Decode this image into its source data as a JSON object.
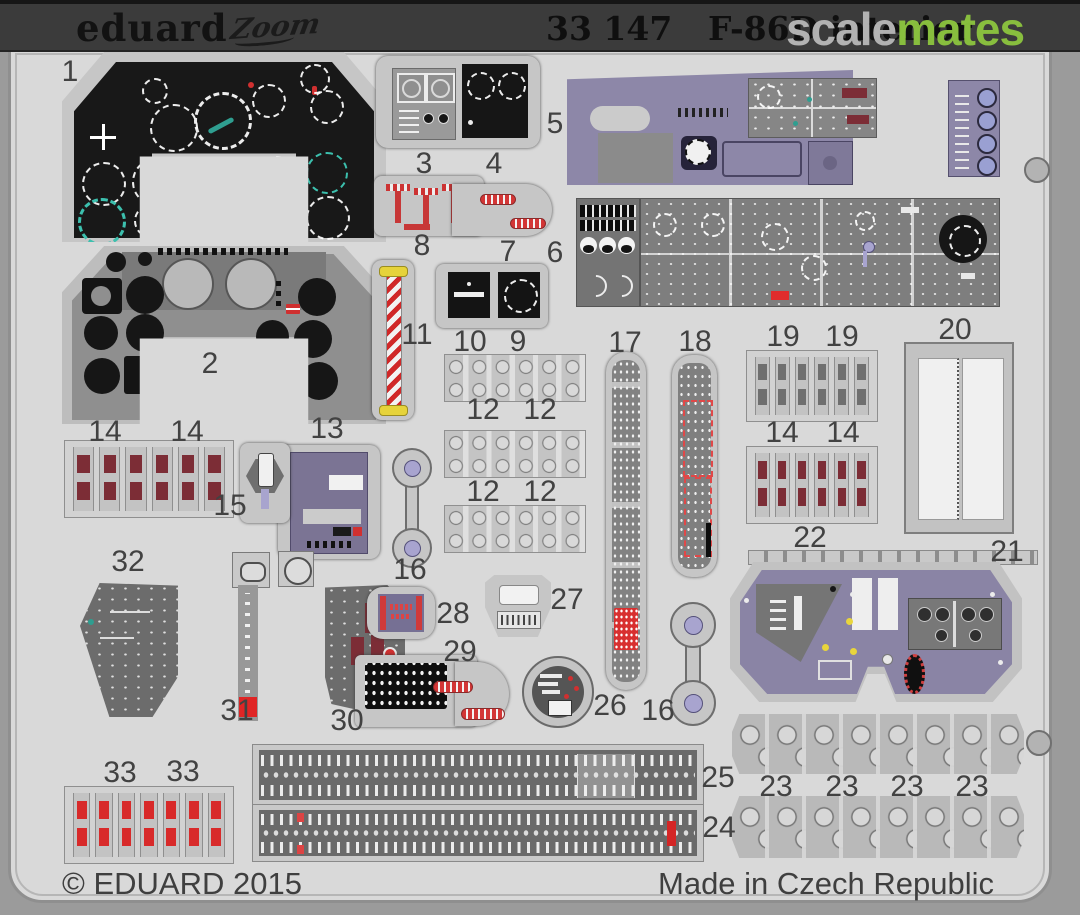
{
  "header": {
    "brand_logo": "eduard",
    "series_logo": "Zoom",
    "catalog_number": "33 147",
    "product_title": "F-86D interior",
    "watermark": {
      "left": "scale",
      "right": "mates"
    }
  },
  "footer": {
    "copyright": "© EDUARD 2015",
    "made_in": "Made in Czech Republic"
  },
  "colors": {
    "header_bar": "#3b3b3b",
    "fret_sheet": "#d9d9d9",
    "photo_margin": "#9b9b9b",
    "watermark_green": "#8dc63f",
    "watermark_gray": "#b9b9b9",
    "panel_black": "#161616",
    "panel_purple": "#8a84a6",
    "belt_maroon": "#7c2d36",
    "belt_red": "#d82a2a",
    "stripe_red": "#d03030",
    "handle_yellow": "#e8d53c",
    "dial_teal": "#3cc0ae"
  },
  "part_labels": [
    {
      "n": "1",
      "x": 70,
      "y": 72
    },
    {
      "n": "2",
      "x": 210,
      "y": 364
    },
    {
      "n": "3",
      "x": 424,
      "y": 164
    },
    {
      "n": "4",
      "x": 494,
      "y": 164
    },
    {
      "n": "5",
      "x": 555,
      "y": 124
    },
    {
      "n": "6",
      "x": 555,
      "y": 253
    },
    {
      "n": "7",
      "x": 508,
      "y": 252
    },
    {
      "n": "8",
      "x": 422,
      "y": 246
    },
    {
      "n": "9",
      "x": 518,
      "y": 342
    },
    {
      "n": "10",
      "x": 470,
      "y": 342
    },
    {
      "n": "11",
      "x": 417,
      "y": 335
    },
    {
      "n": "12",
      "x": 483,
      "y": 410
    },
    {
      "n": "12",
      "x": 540,
      "y": 410
    },
    {
      "n": "12",
      "x": 483,
      "y": 492
    },
    {
      "n": "12",
      "x": 540,
      "y": 492
    },
    {
      "n": "13",
      "x": 327,
      "y": 429
    },
    {
      "n": "14",
      "x": 105,
      "y": 432
    },
    {
      "n": "14",
      "x": 187,
      "y": 432
    },
    {
      "n": "14",
      "x": 782,
      "y": 433
    },
    {
      "n": "14",
      "x": 843,
      "y": 433
    },
    {
      "n": "15",
      "x": 230,
      "y": 506
    },
    {
      "n": "16",
      "x": 410,
      "y": 570
    },
    {
      "n": "16",
      "x": 658,
      "y": 711
    },
    {
      "n": "17",
      "x": 625,
      "y": 343
    },
    {
      "n": "18",
      "x": 695,
      "y": 342
    },
    {
      "n": "19",
      "x": 783,
      "y": 337
    },
    {
      "n": "19",
      "x": 842,
      "y": 337
    },
    {
      "n": "20",
      "x": 955,
      "y": 330
    },
    {
      "n": "21",
      "x": 1007,
      "y": 552
    },
    {
      "n": "22",
      "x": 810,
      "y": 538
    },
    {
      "n": "23",
      "x": 776,
      "y": 787
    },
    {
      "n": "23",
      "x": 842,
      "y": 787
    },
    {
      "n": "23",
      "x": 907,
      "y": 787
    },
    {
      "n": "23",
      "x": 972,
      "y": 787
    },
    {
      "n": "24",
      "x": 719,
      "y": 828
    },
    {
      "n": "25",
      "x": 718,
      "y": 778
    },
    {
      "n": "26",
      "x": 610,
      "y": 706
    },
    {
      "n": "27",
      "x": 567,
      "y": 600
    },
    {
      "n": "28",
      "x": 453,
      "y": 614
    },
    {
      "n": "29",
      "x": 460,
      "y": 652
    },
    {
      "n": "30",
      "x": 347,
      "y": 721
    },
    {
      "n": "31",
      "x": 237,
      "y": 711
    },
    {
      "n": "32",
      "x": 128,
      "y": 562
    },
    {
      "n": "33",
      "x": 120,
      "y": 773
    },
    {
      "n": "33",
      "x": 183,
      "y": 772
    }
  ]
}
